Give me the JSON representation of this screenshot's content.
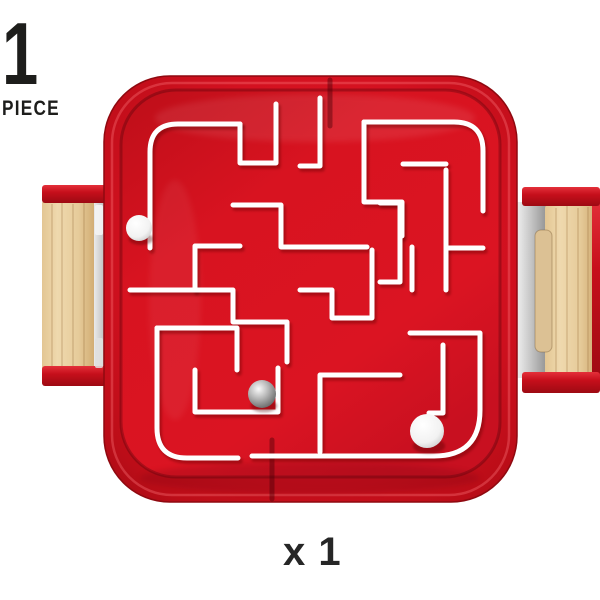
{
  "canvas": {
    "width": 600,
    "height": 600,
    "background": "#ffffff"
  },
  "badge": {
    "quantity": "1",
    "unit": "PIECE",
    "color": "#1d1d1b"
  },
  "footer": {
    "quantity_label": "x 1",
    "color": "#262626"
  },
  "product": {
    "kind": "labyrinth-maze-game",
    "colors": {
      "body_red": "#d51422",
      "body_red_dark": "#a30b14",
      "body_red_light": "#ee2f3a",
      "wall_white": "#ffffff",
      "wood_light": "#eed7ab",
      "wood_dark": "#d8b77e",
      "metal_light": "#e9e9e9",
      "metal_dark": "#969696"
    },
    "maze": {
      "walls": [
        "M 150 248 V 152 Q 150 124 178 124 H 240",
        "M 240 124 V 163 H 276 V 104",
        "M 320 98 V 166 H 300",
        "M 364 122 H 454 Q 483 122 483 151 V 211",
        "M 364 122 V 202 H 402 V 236",
        "M 403 164 H 446",
        "M 446 170 V 290",
        "M 446 248 H 483",
        "M 130 290 H 233 V 322 H 287 V 362",
        "M 195 290 V 246 H 240",
        "M 233 205 H 281 V 247 H 367",
        "M 372 250 V 318 H 332 V 290 H 300",
        "M 412 247 V 290",
        "M 380 203 H 400 V 282 H 380",
        "M 157 328 H 237 V 370",
        "M 157 328 V 428 Q 157 458 187 458 H 238",
        "M 252 456 H 434 Q 480 456 480 410 V 333 H 410",
        "M 195 370 V 412 H 278 V 368",
        "M 400 375 H 320 V 452",
        "M 443 345 V 413 H 429"
      ],
      "seams": [
        {
          "x": 330,
          "y1": 80,
          "y2": 126
        },
        {
          "x": 272,
          "y1": 440,
          "y2": 499
        }
      ],
      "balls": [
        {
          "type": "white",
          "cx": 139,
          "cy": 228,
          "r": 13
        },
        {
          "type": "silver",
          "cx": 262,
          "cy": 394,
          "r": 14
        },
        {
          "type": "white",
          "cx": 427,
          "cy": 431,
          "r": 17
        }
      ]
    }
  }
}
